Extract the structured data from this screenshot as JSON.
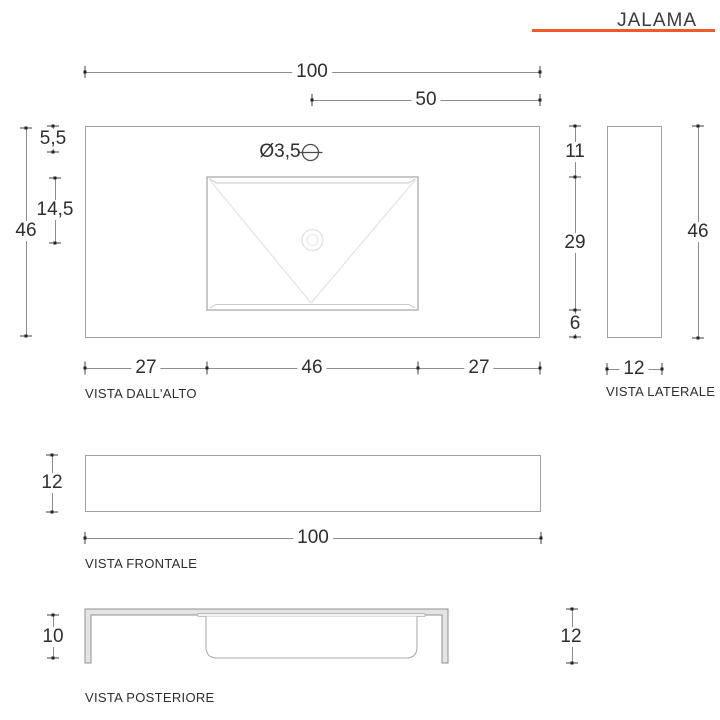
{
  "title": "JALAMA",
  "accent_color": "#f05a28",
  "views": {
    "top": {
      "label": "VISTA DALL'ALTO",
      "dims": {
        "total_width": "100",
        "hole_offset": "50",
        "hole_diameter": "Ø3,5",
        "edge_to_hole": "5,5",
        "hole_to_drain": "14,5",
        "total_depth": "46",
        "top_to_basin": "11",
        "basin_depth": "29",
        "basin_to_edge": "6",
        "bottom_left": "27",
        "basin_width": "46",
        "bottom_right": "27"
      }
    },
    "side": {
      "label": "VISTA LATERALE",
      "dims": {
        "height": "46",
        "width": "12"
      }
    },
    "front": {
      "label": "VISTA FRONTALE",
      "dims": {
        "height": "12",
        "width": "100"
      }
    },
    "rear": {
      "label": "VISTA POSTERIORE",
      "dims": {
        "inner_height": "10",
        "total_height": "12"
      }
    }
  }
}
